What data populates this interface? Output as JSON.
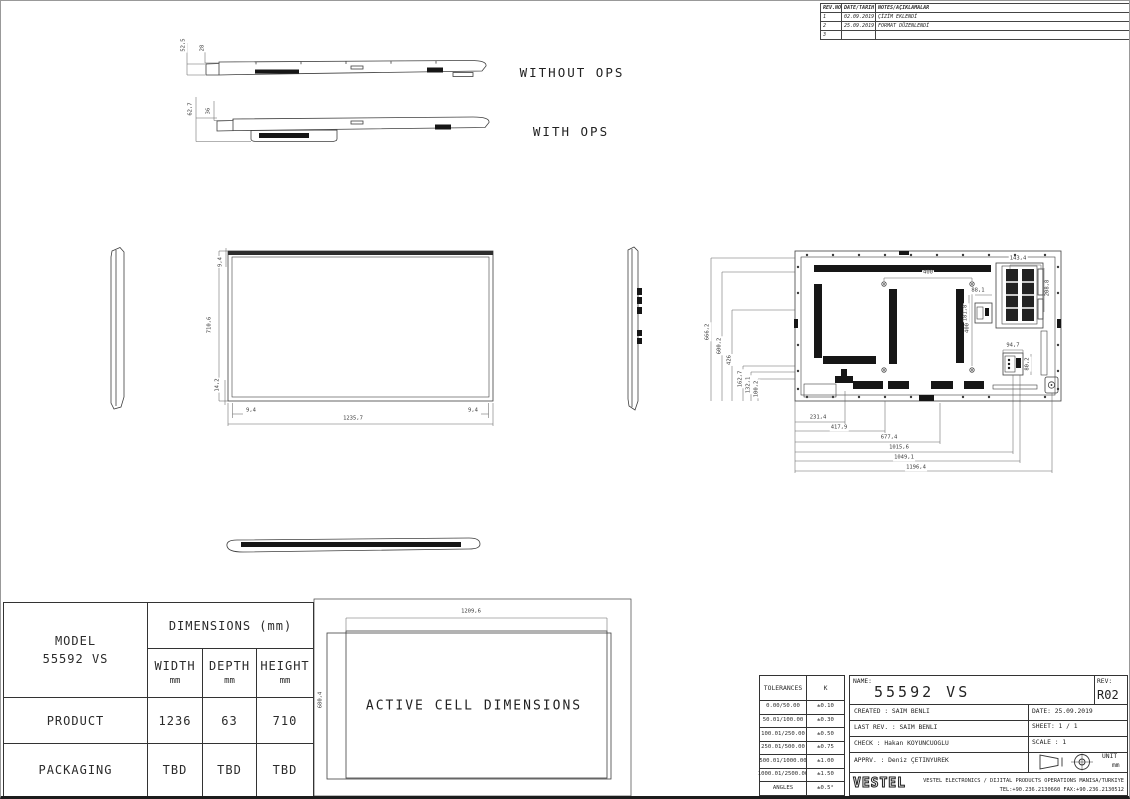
{
  "revision_table": {
    "headers": [
      "REV.NO",
      "DATE/TARIH",
      "NOTES/AÇIKLAMALAR"
    ],
    "rows": [
      {
        "no": "1",
        "date": "02.09.2019",
        "note": "ÇİZİM EKLENDİ"
      },
      {
        "no": "2",
        "date": "25.09.2019",
        "note": "FORMAT DÜZENLENDİ"
      },
      {
        "no": "3",
        "date": "",
        "note": ""
      }
    ]
  },
  "profiles": {
    "without_ops": {
      "label": "WITHOUT OPS",
      "total_depth": "52,5",
      "panel_depth": "28"
    },
    "with_ops": {
      "label": "WITH OPS",
      "total_depth": "62,7",
      "panel_depth": "36"
    }
  },
  "front_view": {
    "height": "710,6",
    "top_bezel": "9,4",
    "bottom_bezel": "14,2",
    "left_bezel": "9,4",
    "right_bezel": "9,4",
    "width": "1235,7"
  },
  "back_view": {
    "left_dims": [
      "666,2",
      "600,2",
      "426",
      "162,7",
      "132,1",
      "100,2"
    ],
    "bottom_dims": [
      "231,4",
      "417,9",
      "677,4",
      "1015,6",
      "1049,1",
      "1196,4"
    ],
    "vesa_horizontal": "400",
    "vesa_vertical": "400",
    "ops_width": "143,4",
    "ops_height": "208,8",
    "module_width": "88,1",
    "module_height": "181,8",
    "connector_width": "94,7",
    "connector_height": "80,2"
  },
  "active_cell": {
    "label": "ACTIVE CELL DIMENSIONS",
    "width": "1209,6",
    "height": "680,4"
  },
  "model_table": {
    "model_label": "MODEL",
    "model": "55592 VS",
    "header": "DIMENSIONS (mm)",
    "columns": [
      "WIDTH",
      "DEPTH",
      "HEIGHT"
    ],
    "unit": "mm",
    "rows": [
      {
        "label": "PRODUCT",
        "width": "1236",
        "depth": "63",
        "height": "710"
      },
      {
        "label": "PACKAGING",
        "width": "TBD",
        "depth": "TBD",
        "height": "TBD"
      }
    ]
  },
  "tolerance_table": {
    "header": [
      "TOLERANCES",
      "K"
    ],
    "rows": [
      {
        "range": "0.00/50.00",
        "value": "±0.10"
      },
      {
        "range": "50.01/100.00",
        "value": "±0.30"
      },
      {
        "range": "100.01/250.00",
        "value": "±0.50"
      },
      {
        "range": "250.01/500.00",
        "value": "±0.75"
      },
      {
        "range": "500.01/1000.00",
        "value": "±1.00"
      },
      {
        "range": "1000.01/2500.00",
        "value": "±1.50"
      },
      {
        "range": "ANGLES",
        "value": "±0.5°"
      }
    ]
  },
  "title_block": {
    "name_label": "NAME:",
    "name": "55592 VS",
    "rev_label": "REV:",
    "rev": "R02",
    "created": "CREATED : SAIM BENLI",
    "date": "DATE: 25.09.2019",
    "last_rev": "LAST REV. : SAIM BENLI",
    "sheet": "SHEET: 1 / 1",
    "check": "CHECK : Hakan KOYUNCUOGLU",
    "scale": "SCALE : 1",
    "approved": "APPRV. : Deniz ÇETINYUREK",
    "unit_label": "UNIT",
    "unit": "mm",
    "logo": "VESTEL",
    "company": "VESTEL ELECTRONICS / DIJITAL PRODUCTS OPERATIONS MANISA/TURKIYE",
    "contact": "TEL:+90.236.2130660 FAX:+90.236.2130512"
  }
}
